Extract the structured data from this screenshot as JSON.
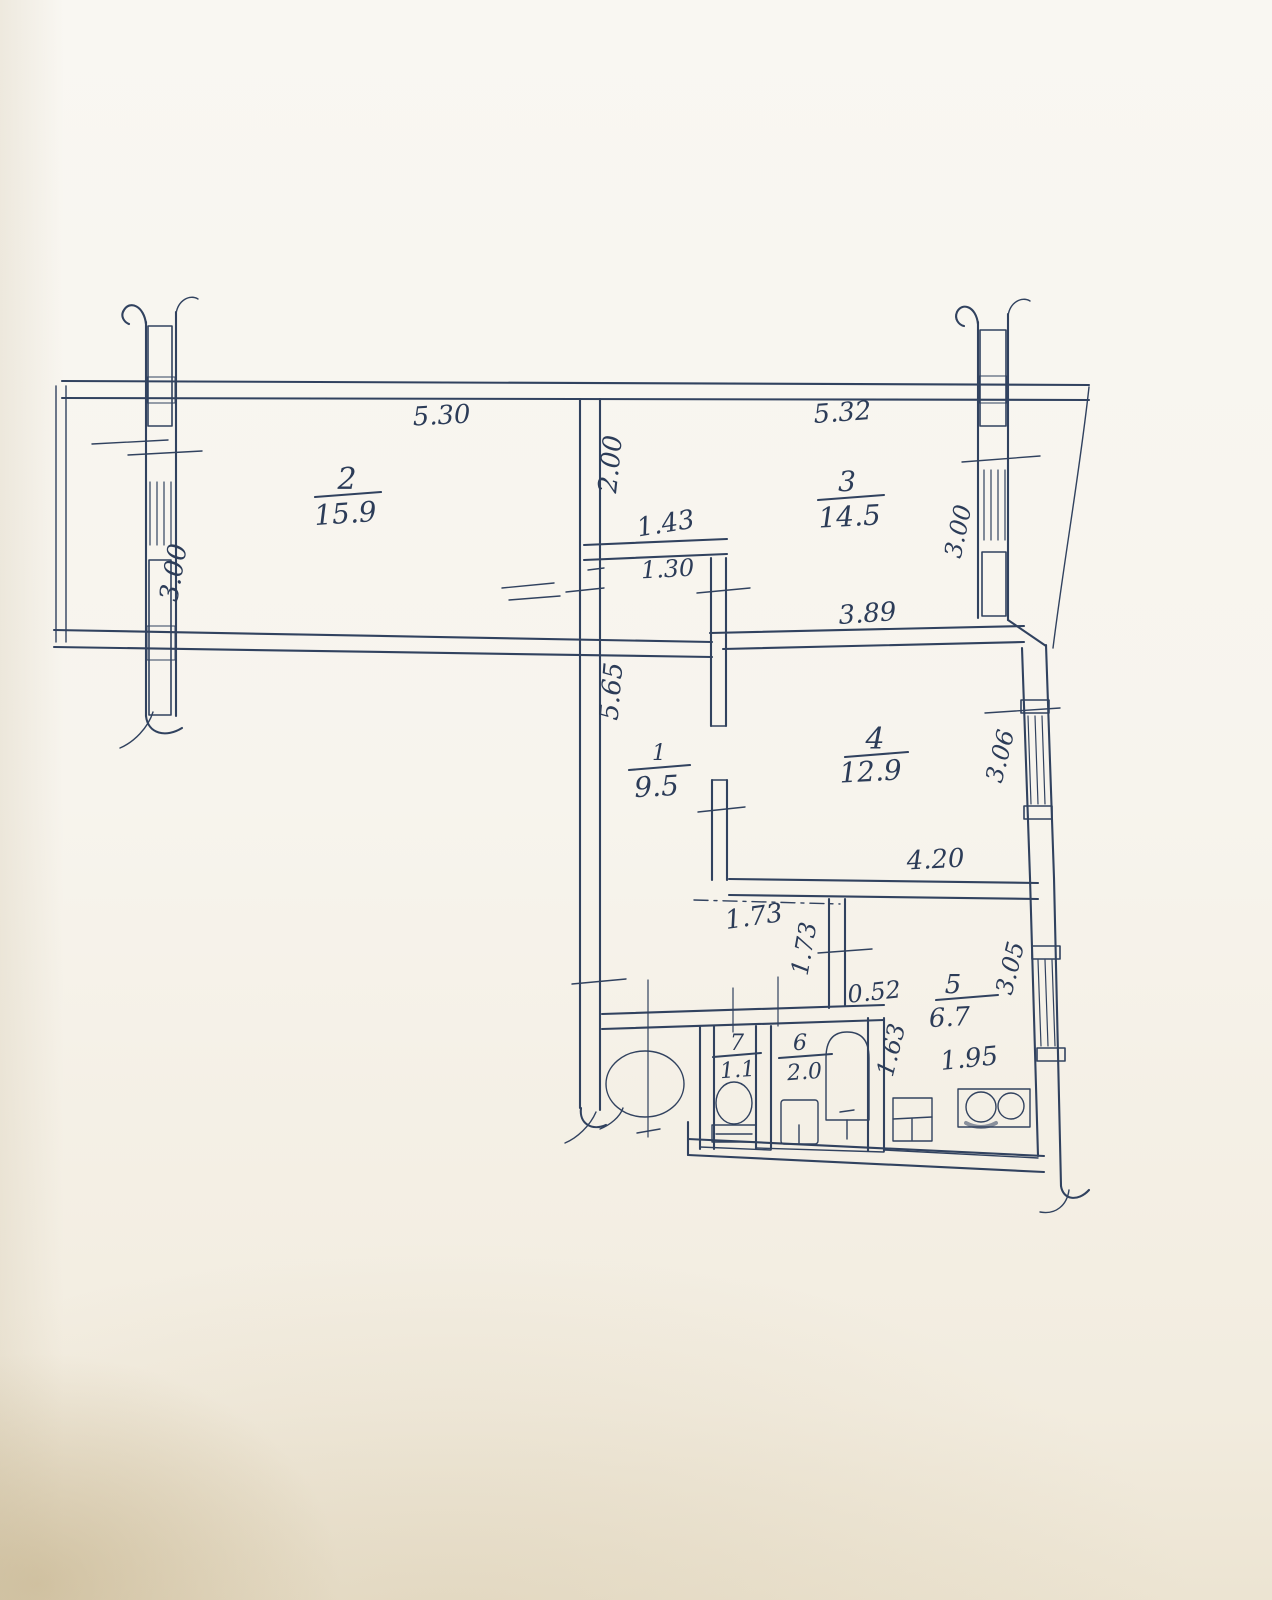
{
  "document": {
    "kind": "hand-drawn apartment floor plan sketch",
    "paper_color": "#f7f4ed",
    "ink_color": "#31425f",
    "window_fill_color": "#8ba3c6",
    "stove_ink_color": "#5558b8"
  },
  "rooms": {
    "hall": {
      "number": "1",
      "area": "9.5"
    },
    "room2": {
      "number": "2",
      "area": "15.9"
    },
    "room3": {
      "number": "3",
      "area": "14.5"
    },
    "room4": {
      "number": "4",
      "area": "12.9"
    },
    "kitchen": {
      "number": "5",
      "area": "6.7"
    },
    "bathroom": {
      "number": "6",
      "area": "2.0"
    },
    "wc": {
      "number": "7",
      "area": "1.1"
    }
  },
  "dimensions": {
    "room2_top_width": "5.30",
    "room3_top_width": "5.32",
    "room2_left_window": "3.00",
    "room3_right_window": "3.00",
    "room3_left_depth": "2.00",
    "closet_width_top": "1.43",
    "closet_width_inner": "1.30",
    "room3_bottom_width": "3.89",
    "hall_length": "5.65",
    "room4_right_window": "3.06",
    "room4_bottom_width": "4.20",
    "hall_bottom_width": "1.73",
    "kitchen_left_wall": "1.73",
    "kitchen_entry_gap": "0.52",
    "kitchen_right_window": "3.05",
    "kitchen_inner_left": "1.63",
    "kitchen_bottom_width": "1.95"
  },
  "fixtures": {
    "toilet": "toilet-bowl-with-tank",
    "bathtub": "bathtub",
    "bath_sink": "wash-basin",
    "kitchen_sink": "kitchen-sink",
    "stove": "two-burner-stove",
    "hall_circle": "round-fixture"
  }
}
